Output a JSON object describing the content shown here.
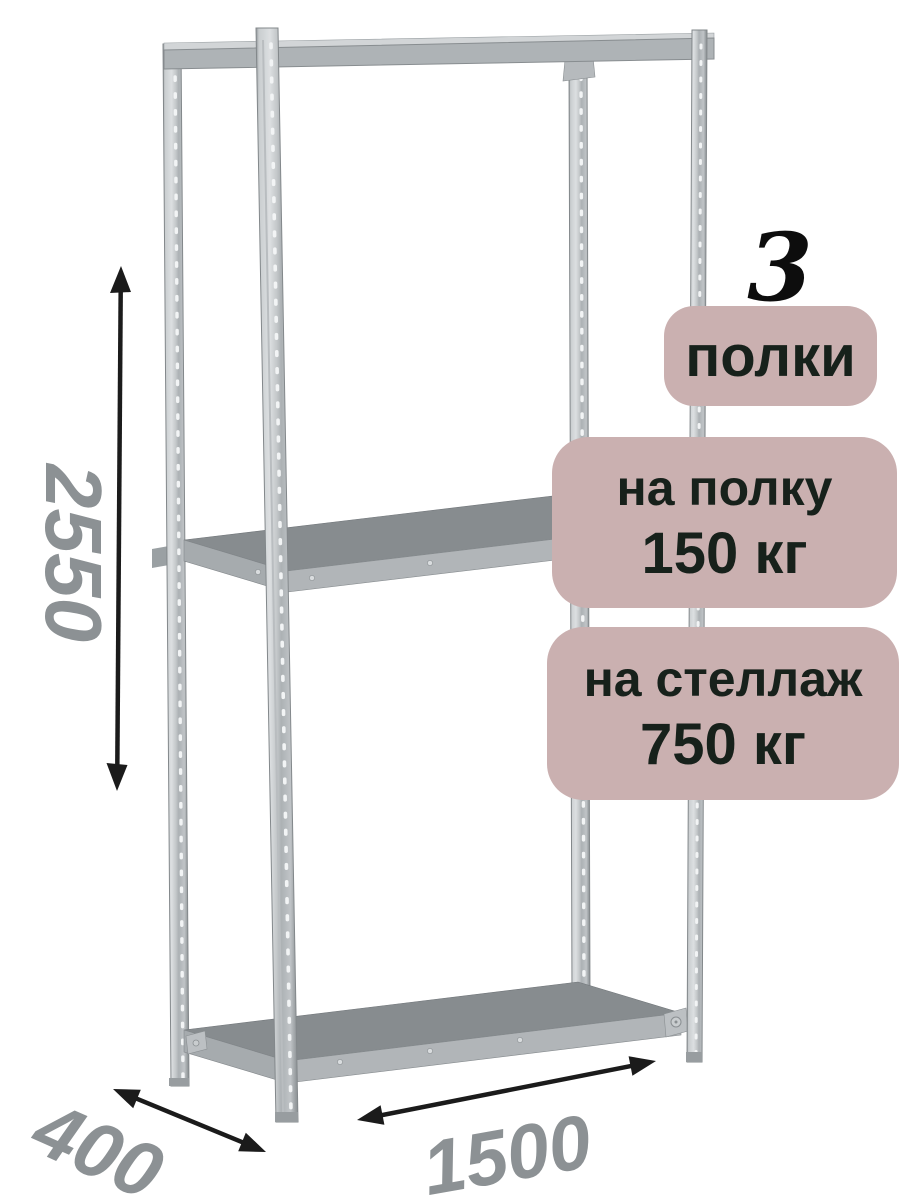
{
  "badges": {
    "count_value": "3",
    "count_label": "полки",
    "per_shelf_line1": "на полку",
    "per_shelf_line2": "150 кг",
    "per_rack_line1": "на стеллаж",
    "per_rack_line2": "750 кг",
    "bg_color": "#cab0b0",
    "text_color": "#17211b"
  },
  "dimensions": {
    "height": "2550",
    "depth": "400",
    "width": "1500",
    "label_color": "#8c9194",
    "arrow_color": "#1b1b1b"
  },
  "illustration": {
    "subject": "metal-shelving-rack-3-shelves",
    "metal_light": "#d7dadc",
    "metal_mid": "#b1b5b8",
    "metal_dark": "#878c8f"
  }
}
